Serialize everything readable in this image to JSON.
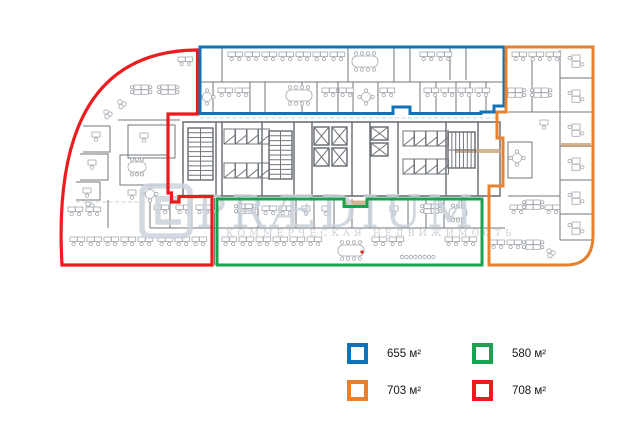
{
  "watermark": {
    "brand": "PRÆDIUM",
    "tagline": "КОММЕРЧЕСКАЯ НЕДВИЖИМОСТЬ"
  },
  "plan": {
    "wall_color": "#72777d",
    "furniture_color": "#a3a8ae"
  },
  "legend": {
    "items": [
      {
        "zone": "blue",
        "label": "655 м²",
        "color": "#1073b8"
      },
      {
        "zone": "green",
        "label": "580 м²",
        "color": "#19a350"
      },
      {
        "zone": "orange",
        "label": "703 м²",
        "color": "#e8812d"
      },
      {
        "zone": "red",
        "label": "708 м²",
        "color": "#ec1b1e"
      }
    ]
  }
}
